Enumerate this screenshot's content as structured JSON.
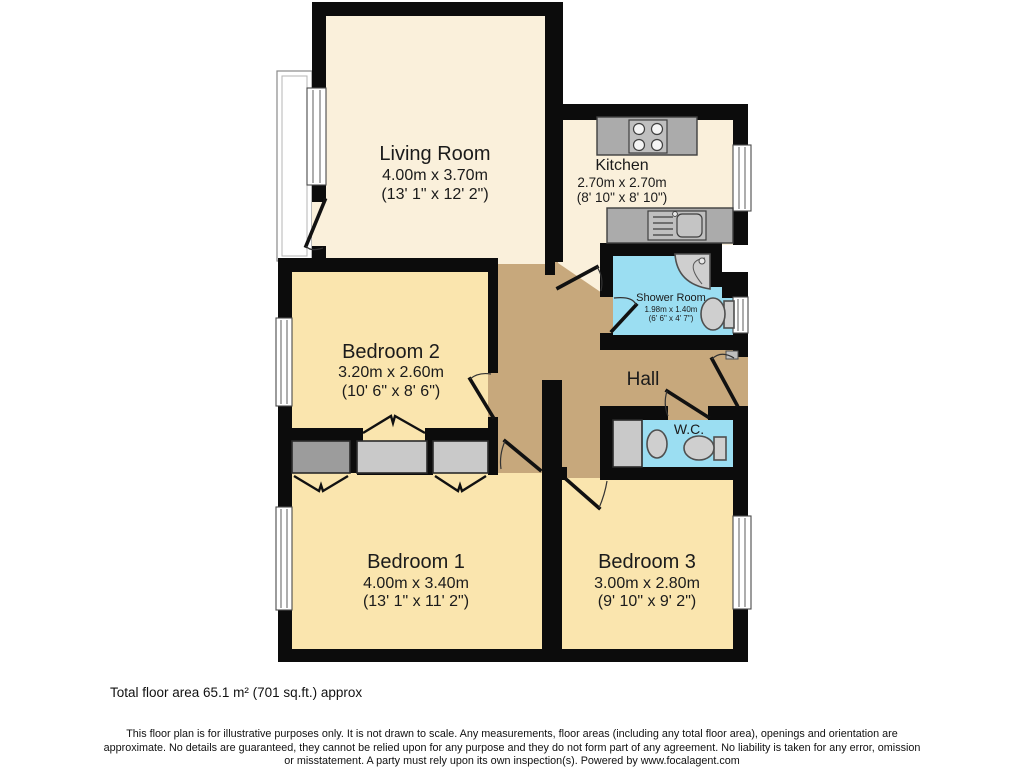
{
  "rooms": {
    "living_room": {
      "name": "Living Room",
      "dims_m": "4.00m x 3.70m",
      "dims_ft": "(13' 1\" x 12' 2\")"
    },
    "kitchen": {
      "name": "Kitchen",
      "dims_m": "2.70m x 2.70m",
      "dims_ft": "(8' 10\" x 8' 10\")"
    },
    "shower_room": {
      "name": "Shower Room",
      "dims_m": "1.98m x 1.40m",
      "dims_ft": "(6' 6\" x 4' 7\")"
    },
    "hall": {
      "name": "Hall"
    },
    "wc": {
      "name": "W.C."
    },
    "bedroom_2": {
      "name": "Bedroom 2",
      "dims_m": "3.20m x 2.60m",
      "dims_ft": "(10' 6\" x 8' 6\")"
    },
    "bedroom_1": {
      "name": "Bedroom 1",
      "dims_m": "4.00m x 3.40m",
      "dims_ft": "(13' 1\" x 11' 2\")"
    },
    "bedroom_3": {
      "name": "Bedroom 3",
      "dims_m": "3.00m x 2.80m",
      "dims_ft": "(9' 10\" x 9' 2\")"
    }
  },
  "footer": {
    "total_area": "Total floor area 65.1 m² (701 sq.ft.) approx",
    "disclaimer_line1": "This floor plan is for illustrative purposes only. It is not drawn to scale. Any measurements, floor areas (including any total floor area), openings and orientation are",
    "disclaimer_line2": "approximate. No details are guaranteed, they cannot be relied upon for any purpose and they do not form part of any agreement. No liability is taken for any error, omission",
    "disclaimer_line3": "or misstatement. A party must rely upon its own inspection(s). Powered by www.focalagent.com"
  },
  "colors": {
    "wall": "#0c0c0c",
    "living_kitchen_floor": "#FAF0DB",
    "bedroom_floor": "#FAE5AE",
    "hall_floor": "#C7A87C",
    "bathroom_floor": "#9BDEF2",
    "counter_gray": "#ABABAB",
    "fixture_gray": "#CFCFCF"
  }
}
